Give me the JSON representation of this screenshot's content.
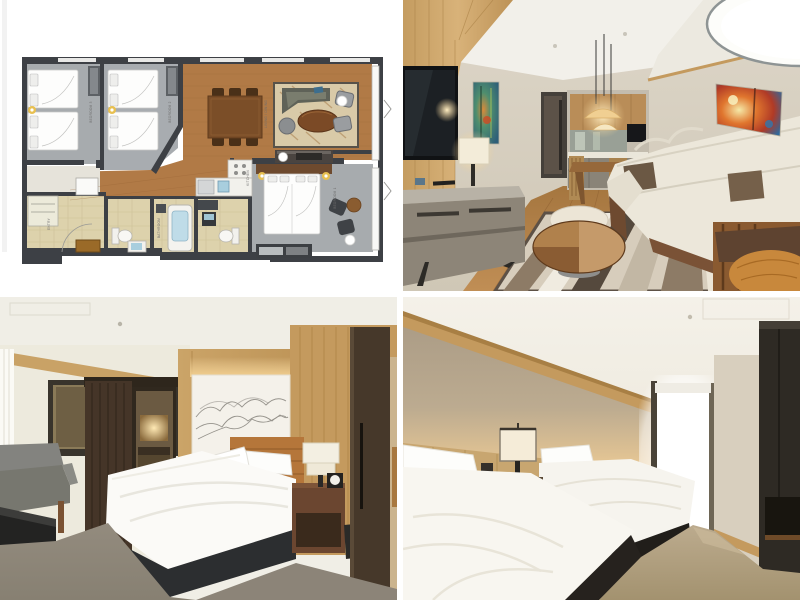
{
  "page": {
    "background": "#ffffff",
    "layout": "2x2 image collage of a hotel suite: floor plan, living room, master bedroom, twin bedroom"
  },
  "floor_plan": {
    "labels": {
      "bedroom1": "BEDROOM 1",
      "bedroom2": "BEDROOM 2",
      "bedroom3": "BEDROOM 3",
      "living_dining": "LIVING / DINING",
      "kitchen": "KITCHEN",
      "bathroom": "BATHROOM",
      "entry": "ENTRY"
    },
    "colors": {
      "wall": "#3d4045",
      "carpet": "#a7abae",
      "wood_floor": "#b17a46",
      "tile_floor": "#ddd2ac",
      "rug": "#d9caa8",
      "bath_water": "#bfdce8",
      "furniture_dark": "#4a3018"
    }
  },
  "living_room_photo": {
    "colors": {
      "wood_wall": "#cfa96c",
      "beige_wall": "#d8d1c2",
      "floor": "#b5854e",
      "sofa": "#ece7da",
      "pillow_brown": "#6b5844",
      "pillow_orange": "#c8883c",
      "console_gray": "#8d8578",
      "pendant_warm": "#f0cf92"
    }
  },
  "master_bedroom_photo": {
    "colors": {
      "wood_panel": "#c9a164",
      "art_panel": "#f4f1ea",
      "headboard_leather": "#b5763a",
      "bed_linen": "#fbfaf7",
      "bed_base": "#2c2e30",
      "carpet": "#8c8478",
      "door_dark": "#46382a",
      "bench_gray": "#80807c"
    }
  },
  "twin_bedroom_photo": {
    "colors": {
      "wallpaper": "#b5a793",
      "cove_glow": "#e8c88f",
      "ceiling": "#f0ece2",
      "duvet": "#f8f6f0",
      "bed_base": "#211e1a",
      "carpet": "#b09f85",
      "wardrobe_dark": "#2e2a24",
      "window_light": "#ffffff"
    }
  }
}
